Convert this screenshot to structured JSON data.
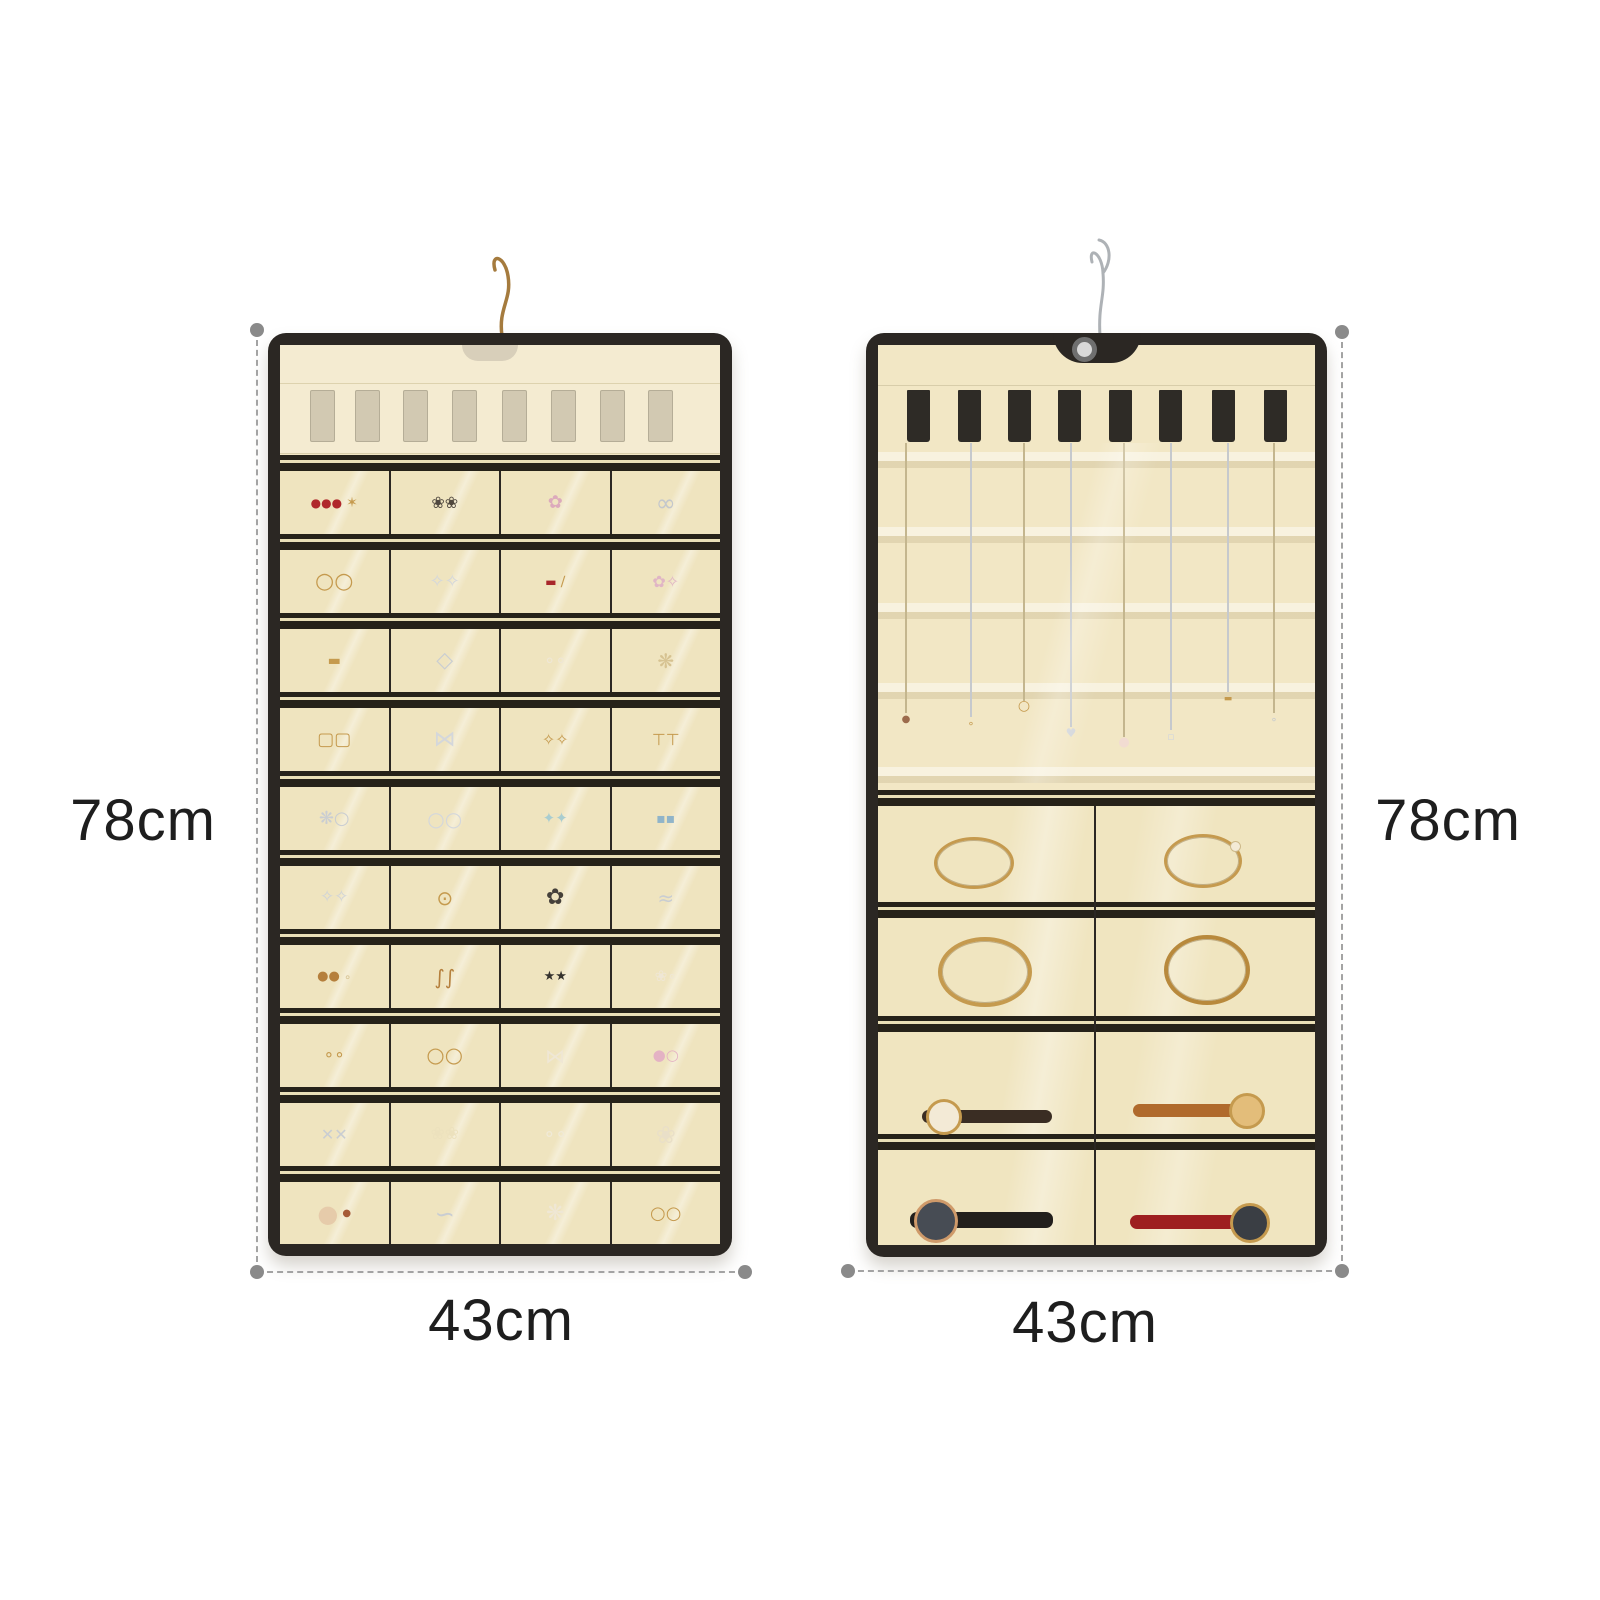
{
  "annotations": {
    "left_height_label": "78cm",
    "left_width_label": "43cm",
    "right_height_label": "78cm",
    "right_width_label": "43cm",
    "line_color": "#a3a3a3",
    "dot_color": "#8a8a8a",
    "text_color": "#1e1e1e"
  },
  "colors": {
    "trim": "#2b2723",
    "fabric": "#f1e6c3",
    "gold": "#c59a4e",
    "silver": "#c9cdd2"
  },
  "left_organizer": {
    "top_slot_count": 8,
    "top_slot_x": [
      30,
      75,
      123,
      172,
      222,
      271,
      320,
      368
    ],
    "pocket_columns": 4,
    "pocket_row_count": 10,
    "rows": [
      [
        [
          {
            "t": "●●●",
            "c": "#b0282c",
            "s": 12
          },
          {
            "t": "✶",
            "c": "#c59a4e",
            "s": 14
          }
        ],
        [
          {
            "t": "❀❀",
            "c": "#50483f",
            "s": 16
          }
        ],
        [
          {
            "t": "✿",
            "c": "#dcaabc",
            "s": 18
          }
        ],
        [
          {
            "t": "∞",
            "c": "#c3c7cc",
            "s": 24
          }
        ]
      ],
      [
        [
          {
            "t": "○○",
            "c": "#c59a4e",
            "s": 22
          }
        ],
        [
          {
            "t": "✧✧",
            "c": "#d4d7db",
            "s": 18
          }
        ],
        [
          {
            "t": "▬",
            "c": "#a8262a",
            "s": 12
          },
          {
            "t": "∕",
            "c": "#c59a4e",
            "s": 14
          }
        ],
        [
          {
            "t": "✿✧",
            "c": "#e0b5c5",
            "s": 16
          }
        ]
      ],
      [
        [
          {
            "t": "▬",
            "c": "#c59a4e",
            "s": 14
          }
        ],
        [
          {
            "t": "◇",
            "c": "#c9cdd2",
            "s": 22
          }
        ],
        [
          {
            "t": "∘∘",
            "c": "#efe7d5",
            "s": 18
          }
        ],
        [
          {
            "t": "❋",
            "c": "#d6c291",
            "s": 20
          }
        ]
      ],
      [
        [
          {
            "t": "▢▢",
            "c": "#c59a4e",
            "s": 18
          }
        ],
        [
          {
            "t": "⋈",
            "c": "#d4d7db",
            "s": 22
          }
        ],
        [
          {
            "t": "✧✧",
            "c": "#c59a4e",
            "s": 16
          }
        ],
        [
          {
            "t": "⊤⊤",
            "c": "#c59a4e",
            "s": 16
          }
        ]
      ],
      [
        [
          {
            "t": "❋○",
            "c": "#c9cdd2",
            "s": 18
          }
        ],
        [
          {
            "t": "○○",
            "c": "#d4d7db",
            "s": 20
          }
        ],
        [
          {
            "t": "✦✦",
            "c": "#a9cdd0",
            "s": 15
          }
        ],
        [
          {
            "t": "▪▪",
            "c": "#90b4c9",
            "s": 14
          }
        ]
      ],
      [
        [
          {
            "t": "✧✧",
            "c": "#cfd3d8",
            "s": 17
          }
        ],
        [
          {
            "t": "⊙",
            "c": "#c59a4e",
            "s": 20
          }
        ],
        [
          {
            "t": "✿",
            "c": "#45403a",
            "s": 22
          }
        ],
        [
          {
            "t": "≈",
            "c": "#c9cdd2",
            "s": 20
          }
        ]
      ],
      [
        [
          {
            "t": "●●",
            "c": "#b57f3c",
            "s": 13
          },
          {
            "t": "∘",
            "c": "#d6c291",
            "s": 12
          }
        ],
        [
          {
            "t": "∫∫",
            "c": "#b57f3c",
            "s": 20
          }
        ],
        [
          {
            "t": "★★",
            "c": "#35322e",
            "s": 13
          }
        ],
        [
          {
            "t": "❀∘",
            "c": "#efe7d5",
            "s": 15
          }
        ]
      ],
      [
        [
          {
            "t": "∘∘",
            "c": "#c59a4e",
            "s": 17
          }
        ],
        [
          {
            "t": "○○",
            "c": "#c59a4e",
            "s": 21
          }
        ],
        [
          {
            "t": "⋈",
            "c": "#efe7d5",
            "s": 20
          }
        ],
        [
          {
            "t": "●○",
            "c": "#e4b2c4",
            "s": 15
          }
        ]
      ],
      [
        [
          {
            "t": "✕✕",
            "c": "#c9cdd2",
            "s": 16
          }
        ],
        [
          {
            "t": "❀❀",
            "c": "#ece1bd",
            "s": 17
          }
        ],
        [
          {
            "t": "∘∘",
            "c": "#f0ead8",
            "s": 19
          }
        ],
        [
          {
            "t": "❀",
            "c": "#e9dfc8",
            "s": 24
          }
        ]
      ],
      [
        [
          {
            "t": "●",
            "c": "#e6cbaa",
            "s": 24
          },
          {
            "t": "●",
            "c": "#a65b37",
            "s": 10
          }
        ],
        [
          {
            "t": "∽",
            "c": "#c9cdd2",
            "s": 24
          }
        ],
        [
          {
            "t": "❋",
            "c": "#efe7d5",
            "s": 22
          }
        ],
        [
          {
            "t": "○○",
            "c": "#c59a4e",
            "s": 18
          }
        ]
      ]
    ]
  },
  "right_organizer": {
    "tab_count": 8,
    "tab_x": [
      29,
      80,
      130,
      180,
      231,
      281,
      334,
      386
    ],
    "necklaces": [
      {
        "x": 27,
        "len": 270,
        "cc": "#c4b68e",
        "p": {
          "t": "●",
          "c": "#9c6b4c",
          "s": 10
        }
      },
      {
        "x": 92,
        "len": 274,
        "cc": "#c6c9cd",
        "p": {
          "t": "∘",
          "c": "#c59a4e",
          "s": 11
        }
      },
      {
        "x": 145,
        "len": 258,
        "cc": "#c4b68e",
        "p": {
          "t": "○",
          "c": "#c59a4e",
          "s": 14
        }
      },
      {
        "x": 192,
        "len": 284,
        "cc": "#c6c9cd",
        "p": {
          "t": "♥",
          "c": "#d4d7db",
          "s": 12
        }
      },
      {
        "x": 245,
        "len": 294,
        "cc": "#c4b68e",
        "p": {
          "t": "●",
          "c": "#f2dcd2",
          "s": 13
        }
      },
      {
        "x": 292,
        "len": 287,
        "cc": "#c6c9cd",
        "p": {
          "t": "▫",
          "c": "#d4d7db",
          "s": 11
        }
      },
      {
        "x": 349,
        "len": 249,
        "cc": "#c6c9cd",
        "p": {
          "t": "▬",
          "c": "#c59a4e",
          "s": 9
        }
      },
      {
        "x": 395,
        "len": 270,
        "cc": "#c4b68e",
        "p": {
          "t": "∘",
          "c": "#c6c9cd",
          "s": 11
        }
      }
    ],
    "stripe_y": [
      107,
      182,
      258,
      338,
      422
    ],
    "pocket_rows": [
      {
        "top": 461,
        "h": 96,
        "items": [
          {
            "type": "bangle",
            "cx": 93,
            "cy": 54,
            "w": 74,
            "h": 46,
            "ring": "#c59a4e",
            "bw": 3
          },
          {
            "type": "bracelet",
            "cx": 322,
            "cy": 52,
            "w": 72,
            "h": 48,
            "ring": "#c59a4e",
            "bw": 3
          }
        ]
      },
      {
        "top": 573,
        "h": 98,
        "items": [
          {
            "type": "bangle",
            "cx": 103,
            "cy": 50,
            "w": 86,
            "h": 62,
            "ring": "#c59a4e",
            "bw": 4
          },
          {
            "type": "bangle",
            "cx": 325,
            "cy": 48,
            "w": 78,
            "h": 62,
            "ring": "#b8893c",
            "bw": 4
          }
        ]
      },
      {
        "top": 687,
        "h": 102,
        "items": [
          {
            "type": "watch",
            "x0": 44,
            "x1": 174,
            "cy": 84,
            "sh": 13,
            "strap": "#3a2d23",
            "face": "#f3ead6",
            "rim": "#c59a4e",
            "fd": 30,
            "facePos": "left"
          },
          {
            "type": "watch",
            "x0": 255,
            "x1": 385,
            "cy": 78,
            "sh": 13,
            "strap": "#b06a2c",
            "face": "#e3bd7a",
            "rim": "#c59a4e",
            "fd": 30,
            "facePos": "right"
          }
        ]
      },
      {
        "top": 805,
        "h": 95,
        "items": [
          {
            "type": "watch",
            "x0": 32,
            "x1": 175,
            "cy": 70,
            "sh": 16,
            "strap": "#221f1c",
            "face": "#474c54",
            "rim": "#cf9a6a",
            "fd": 38,
            "facePos": "left"
          },
          {
            "type": "watch",
            "x0": 252,
            "x1": 390,
            "cy": 72,
            "sh": 14,
            "strap": "#9e1f20",
            "face": "#3a3e44",
            "rim": "#c59a4e",
            "fd": 34,
            "facePos": "right"
          }
        ]
      }
    ],
    "row_sep_y": [
      557,
      671,
      789
    ],
    "main_divider_y": 445,
    "center_divider_x": 216
  }
}
